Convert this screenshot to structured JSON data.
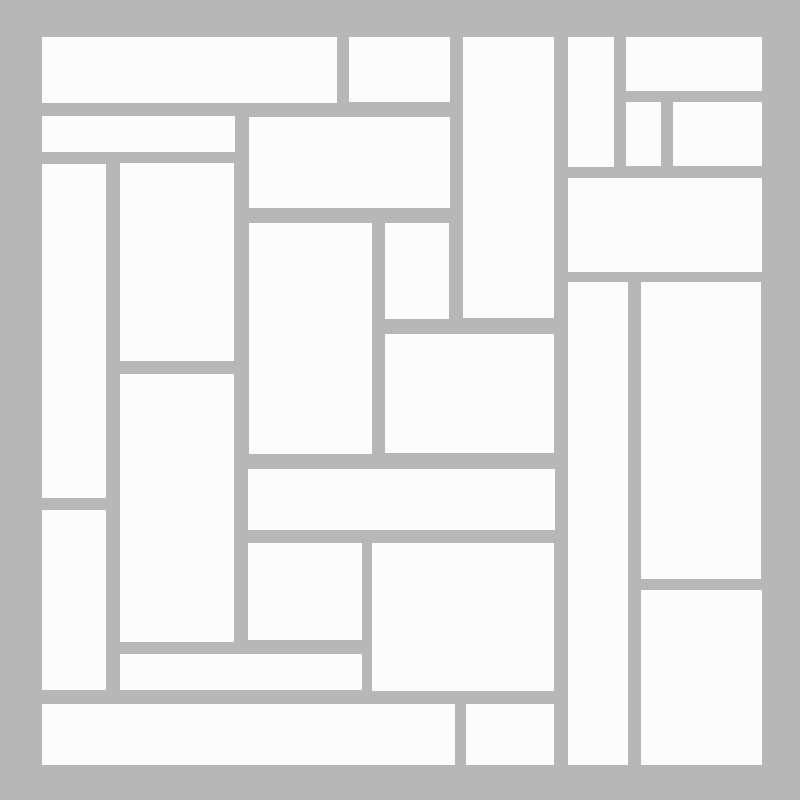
{
  "title": "Rectangle mosaic tiling",
  "canvas": {
    "width": 800,
    "height": 800
  },
  "colors": {
    "background": "#b7b7b7",
    "tile": "#fcfcfc"
  },
  "tiles": [
    {
      "id": "tile-top-left-wide",
      "x": 42,
      "y": 37,
      "w": 295,
      "h": 66
    },
    {
      "id": "tile-top-small",
      "x": 349,
      "y": 37,
      "w": 101,
      "h": 65
    },
    {
      "id": "tile-upper-mid-tall",
      "x": 463,
      "y": 37,
      "w": 91,
      "h": 281
    },
    {
      "id": "tile-top-narrow-column",
      "x": 568,
      "y": 37,
      "w": 46,
      "h": 130
    },
    {
      "id": "tile-top-right-wide",
      "x": 626,
      "y": 37,
      "w": 136,
      "h": 54
    },
    {
      "id": "tile-left-thin-bar",
      "x": 42,
      "y": 116,
      "w": 193,
      "h": 36
    },
    {
      "id": "tile-upper-mid-block",
      "x": 249,
      "y": 117,
      "w": 201,
      "h": 91
    },
    {
      "id": "tile-right-small-square",
      "x": 626,
      "y": 102,
      "w": 35,
      "h": 64
    },
    {
      "id": "tile-right-small-block",
      "x": 673,
      "y": 102,
      "w": 89,
      "h": 64
    },
    {
      "id": "tile-left-tall-column",
      "x": 42,
      "y": 164,
      "w": 64,
      "h": 334
    },
    {
      "id": "tile-left-mid-column",
      "x": 120,
      "y": 163,
      "w": 114,
      "h": 198
    },
    {
      "id": "tile-right-wide-block",
      "x": 568,
      "y": 178,
      "w": 194,
      "h": 94
    },
    {
      "id": "tile-center-tall-block",
      "x": 249,
      "y": 223,
      "w": 123,
      "h": 231
    },
    {
      "id": "tile-center-small-col",
      "x": 385,
      "y": 223,
      "w": 64,
      "h": 96
    },
    {
      "id": "tile-right-long-column",
      "x": 568,
      "y": 282,
      "w": 60,
      "h": 483
    },
    {
      "id": "tile-right-tall-block",
      "x": 641,
      "y": 282,
      "w": 120,
      "h": 297
    },
    {
      "id": "tile-center-block",
      "x": 385,
      "y": 334,
      "w": 169,
      "h": 119
    },
    {
      "id": "tile-lower-left-column",
      "x": 120,
      "y": 374,
      "w": 114,
      "h": 268
    },
    {
      "id": "tile-center-wide-bar",
      "x": 248,
      "y": 469,
      "w": 307,
      "h": 61
    },
    {
      "id": "tile-left-lower-column",
      "x": 42,
      "y": 510,
      "w": 64,
      "h": 180
    },
    {
      "id": "tile-lower-mid-small",
      "x": 248,
      "y": 543,
      "w": 114,
      "h": 97
    },
    {
      "id": "tile-lower-mid-block",
      "x": 372,
      "y": 543,
      "w": 182,
      "h": 148
    },
    {
      "id": "tile-bottom-right-block",
      "x": 641,
      "y": 590,
      "w": 121,
      "h": 175
    },
    {
      "id": "tile-bottom-thin-bar",
      "x": 120,
      "y": 654,
      "w": 242,
      "h": 36
    },
    {
      "id": "tile-bottom-wide-bar",
      "x": 42,
      "y": 704,
      "w": 413,
      "h": 61
    },
    {
      "id": "tile-bottom-small-block",
      "x": 466,
      "y": 704,
      "w": 88,
      "h": 61
    }
  ]
}
